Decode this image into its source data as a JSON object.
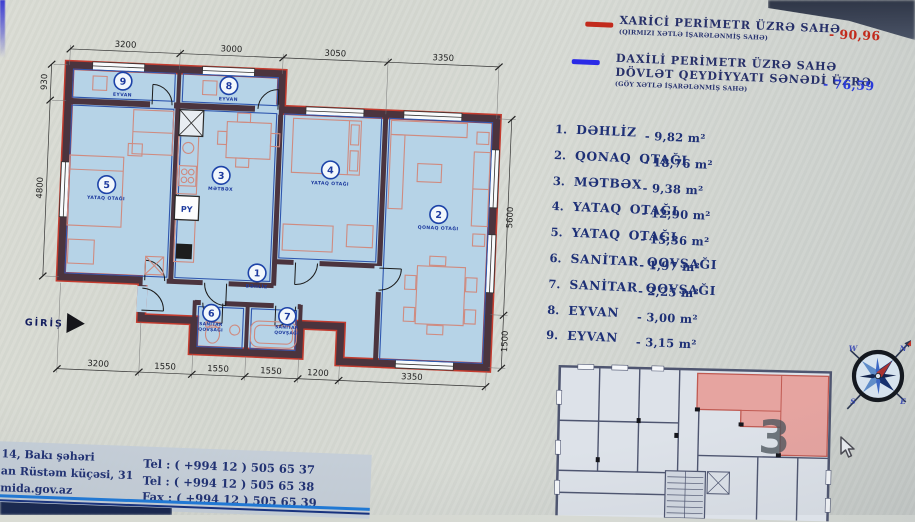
{
  "colors": {
    "exterior_line": "#c0392b",
    "interior_line": "#2a3ada",
    "accent_navy": "#1e3076",
    "wall": "#4b343e",
    "room_fill": "#b6d3e7",
    "highlight_unit": "#e79d98"
  },
  "legend": {
    "items": [
      {
        "title_lines": [
          "XARİCİ PERİMETR ÜZRƏ SAHƏ",
          ""
        ],
        "subtitle": "(QIRMIZI XƏTLƏ İŞARƏLƏNMİŞ SAHƏ)",
        "value": "- 90,96",
        "color": "#c22a1c"
      },
      {
        "title_lines": [
          "DAXİLİ PERİMETR ÜZRƏ SAHƏ",
          "DÖVLƏT QEYDİYYATI SƏNƏDİ ÜZRƏ"
        ],
        "subtitle": "(GÖY XƏTLƏ İŞARƏLƏNMİŞ SAHƏ)",
        "value": "- 76,59",
        "color": "#2a3ada"
      }
    ]
  },
  "room_list": [
    {
      "num": "1.",
      "name": "DƏHLİZ",
      "area": "- 9,82 m²"
    },
    {
      "num": "2.",
      "name": "QONAQ OTAĞI",
      "area": "- 18,76 m²"
    },
    {
      "num": "3.",
      "name": "MƏTBƏX",
      "area": "- 9,38 m²"
    },
    {
      "num": "4.",
      "name": "YATAQ OTAĞI",
      "area": "- 12,90 m²"
    },
    {
      "num": "5.",
      "name": "YATAQ OTAĞI",
      "area": "- 15,36 m²"
    },
    {
      "num": "6.",
      "name": "SANİTAR QOVŞAĞI",
      "area": "- 1,97 m²"
    },
    {
      "num": "7.",
      "name": "SANİTAR QOVŞAĞI",
      "area": "- 2,25 m²"
    },
    {
      "num": "8.",
      "name": "EYVAN",
      "area": "- 3,00 m²"
    },
    {
      "num": "9.",
      "name": "EYVAN",
      "area": "- 3,15 m²"
    }
  ],
  "plan": {
    "dims_top": [
      "3200",
      "3000",
      "3050",
      "3350"
    ],
    "dims_bottom": [
      "3200",
      "1550",
      "1550",
      "1550",
      "1200",
      "3350"
    ],
    "dims_left": [
      "930",
      "4800"
    ],
    "dims_right": [
      "5600",
      "1500"
    ],
    "markers": [
      {
        "num": "9",
        "line1": "EYVAN",
        "line2": ""
      },
      {
        "num": "8",
        "line1": "EYVAN",
        "line2": ""
      },
      {
        "num": "5",
        "line1": "YATAQ OTAĞI",
        "line2": ""
      },
      {
        "num": "3",
        "line1": "MƏTBƏX",
        "line2": ""
      },
      {
        "num": "4",
        "line1": "YATAQ OTAĞI",
        "line2": ""
      },
      {
        "num": "2",
        "line1": "QONAQ OTAĞI",
        "line2": ""
      },
      {
        "num": "1",
        "line1": "DƏHLİZ",
        "line2": ""
      },
      {
        "num": "6",
        "line1": "SANİTAR",
        "line2": "QOVŞAĞI"
      },
      {
        "num": "7",
        "line1": "SANİTAR",
        "line2": "QOVŞAĞI"
      }
    ],
    "entry_label": "GİRİŞ",
    "shaft_label": "PY"
  },
  "footer": {
    "address_lines": [
      "14, Bakı şəhəri",
      "an Rüstəm küçəsi, 31",
      "mida.gov.az"
    ],
    "contact_lines": [
      "Tel : ( +994 12 ) 505 65 37",
      "Tel : ( +994 12 ) 505 65 38",
      "Fax : ( +994 12 ) 505 65 39"
    ]
  },
  "keyplan": {
    "unit_number": "3"
  },
  "compass": {
    "n": "N",
    "e": "E",
    "s": "S",
    "w": "W"
  }
}
